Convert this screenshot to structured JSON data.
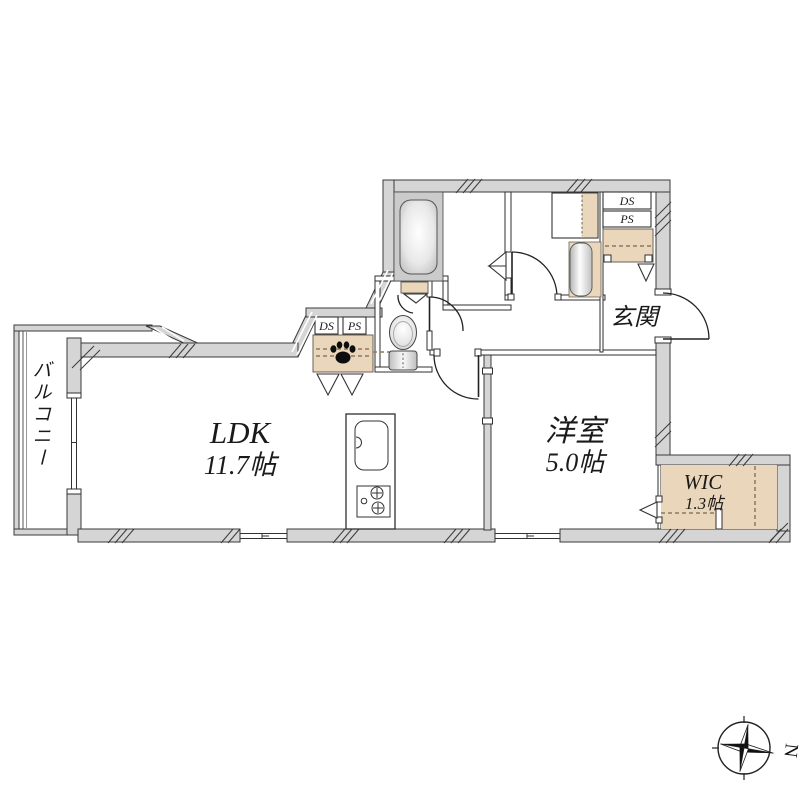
{
  "plan": {
    "rooms": {
      "balcony": {
        "label": "バルコニー"
      },
      "ldk": {
        "name": "LDK",
        "size": "11.7帖"
      },
      "western_room": {
        "name": "洋室",
        "size": "5.0帖"
      },
      "wic": {
        "name": "WIC",
        "size": "1.3帖"
      },
      "entrance": {
        "label": "玄関"
      }
    },
    "shafts": {
      "ds_top": "DS",
      "ps_top": "PS",
      "ds_mid": "DS",
      "ps_mid": "PS"
    },
    "compass": {
      "north_label": "N"
    },
    "colors": {
      "wall": "#d5d5d5",
      "wall_line": "#3a3a3a",
      "thin_line": "#2f2f2f",
      "closet_fill": "#e9d6bb",
      "closet_line": "#6b6354",
      "dash_line": "#8a7a5e",
      "bath_fill": "#cbcbcb",
      "ink": "#1a1a1a",
      "bg": "#ffffff"
    }
  }
}
